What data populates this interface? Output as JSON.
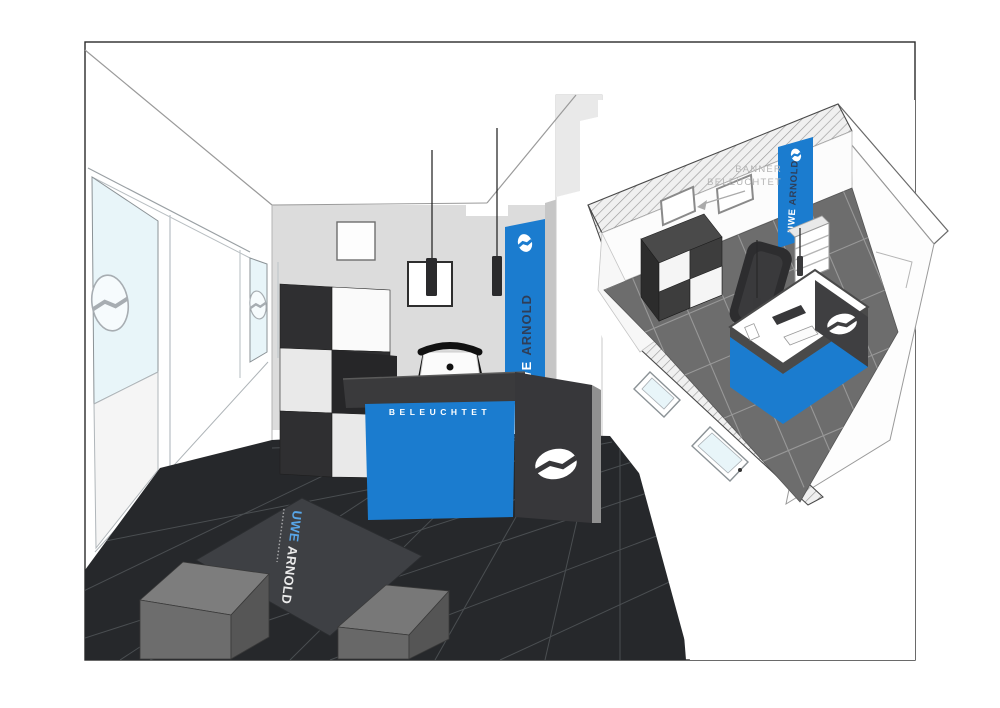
{
  "drawing": {
    "brand": {
      "first": "UWE",
      "second": "ARNOLD"
    },
    "left_view": {
      "banner": {
        "first": "UWE",
        "second": "ARNOLD"
      },
      "desk_label": "BELEUCHTET",
      "mat": {
        "first": "UWE",
        "second": "ARNOLD"
      }
    },
    "iso_view": {
      "annotation": {
        "line1": "BANNER",
        "line2": "BELEUCHTET"
      },
      "banner": {
        "first": "UWE",
        "second": "ARNOLD"
      }
    },
    "colors": {
      "accent_blue": "#1b7ccf",
      "navy": "#2f3e58",
      "desk_dark": "#3a3a3c",
      "floor_dark": "#26282b",
      "floor_iso": "#6d6d6d",
      "glass": "#e8f5f9"
    }
  }
}
